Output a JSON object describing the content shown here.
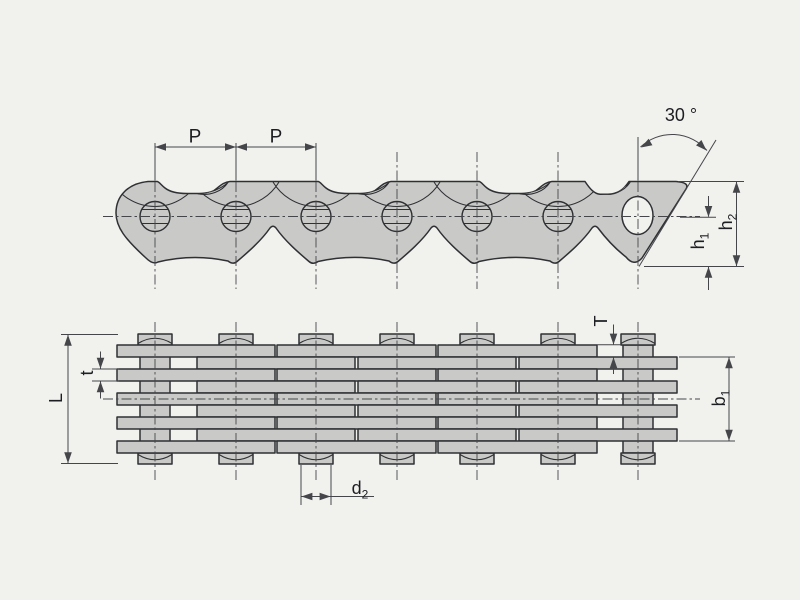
{
  "labels": {
    "pitch_1": "P",
    "pitch_2": "P",
    "angle": "30 °",
    "height_h1": {
      "base": "h",
      "sub": "1"
    },
    "height_h2": {
      "base": "h",
      "sub": "2"
    },
    "plate_thickness_T": "T",
    "inner_plate_thickness_t": "t",
    "pin_length_L": "L",
    "inner_width_b1": {
      "base": "b",
      "sub": "1"
    },
    "pin_diameter_d2": {
      "base": "d",
      "sub": "2"
    }
  },
  "colors": {
    "background": "#f1f1ee",
    "part_fill": "#c9cac7",
    "outline": "#2f3033",
    "dimension_line": "#45464a",
    "label_text": "#1d1e22"
  }
}
